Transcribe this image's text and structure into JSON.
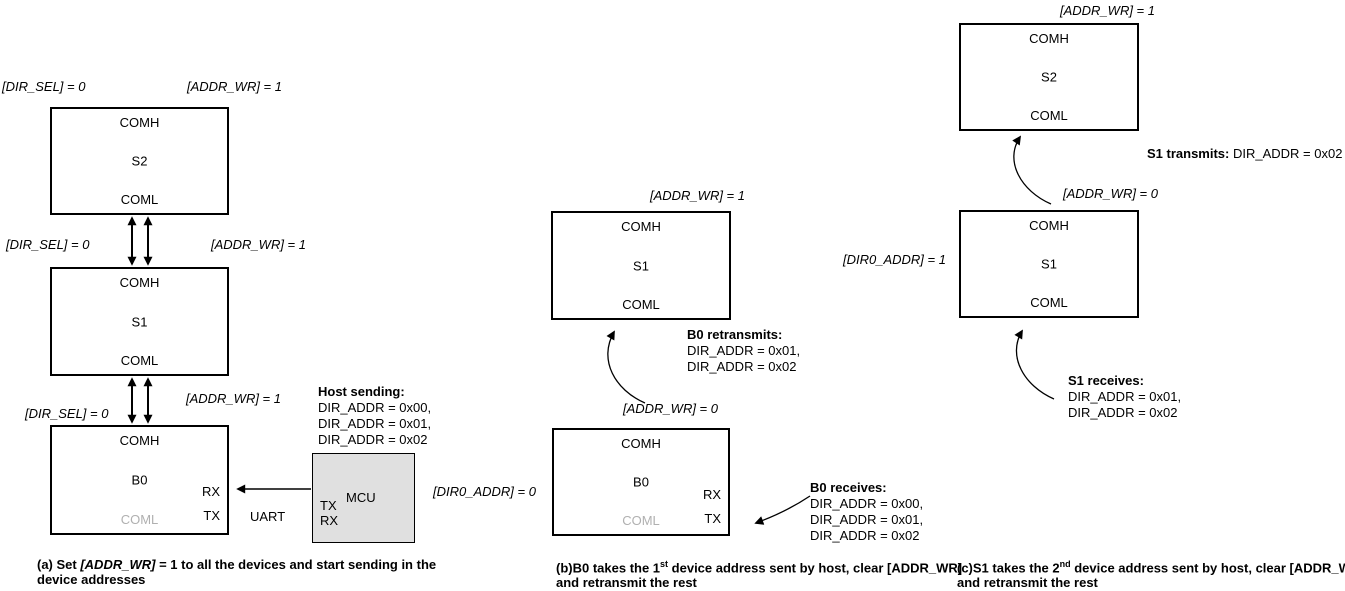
{
  "colors": {
    "line": "#000000",
    "muted_port": "#b0b0b0",
    "mcu_fill": "#e0e0e0"
  },
  "ports": {
    "comh": "COMH",
    "coml": "COML",
    "rx": "RX",
    "tx": "TX"
  },
  "signals": {
    "dir_sel_0": "[DIR_SEL] = 0",
    "addr_wr_1": "[ADDR_WR] = 1",
    "addr_wr_0": "[ADDR_WR] = 0",
    "dir0_addr_0": "[DIR0_ADDR] = 0",
    "dir0_addr_1": "[DIR0_ADDR] = 1"
  },
  "diagram_a": {
    "device_top": "S2",
    "device_middle": "S1",
    "device_bottom": "B0",
    "mcu_label": "MCU",
    "uart_label": "UART",
    "host_sending": {
      "title": "Host sending:",
      "lines": [
        "DIR_ADDR = 0x00,",
        "DIR_ADDR = 0x01,",
        "DIR_ADDR = 0x02"
      ]
    },
    "caption": {
      "line1_pre": "(a) Set ",
      "line1_italic": "[ADDR_WR]",
      "line1_post": " = 1 to all the devices and start sending in the",
      "line2": "device addresses"
    }
  },
  "diagram_b": {
    "device_top": "S1",
    "device_bottom": "B0",
    "retransmits": {
      "title": "B0 retransmits:",
      "lines": [
        "DIR_ADDR = 0x01,",
        "DIR_ADDR = 0x02"
      ]
    },
    "receives": {
      "title": "B0 receives:",
      "lines": [
        "DIR_ADDR = 0x00,",
        "DIR_ADDR = 0x01,",
        "DIR_ADDR = 0x02"
      ]
    },
    "caption": {
      "line1_pre": "(b)B0 takes the 1",
      "line1_sup": "st",
      "line1_post": " device address sent by host, clear [ADDR_WR]",
      "line2": "and retransmit the rest"
    }
  },
  "diagram_c": {
    "device_top": "S2",
    "device_bottom": "S1",
    "transmits": {
      "title": "S1 transmits:",
      "text": " DIR_ADDR = 0x02"
    },
    "receives": {
      "title": "S1 receives:",
      "lines": [
        "DIR_ADDR = 0x01,",
        "DIR_ADDR = 0x02"
      ]
    },
    "caption": {
      "line1_pre": "(c)S1 takes the 2",
      "line1_sup": "nd",
      "line1_post": " device address sent by host, clear [ADDR_WR]",
      "line2": "and retransmit the rest"
    }
  }
}
